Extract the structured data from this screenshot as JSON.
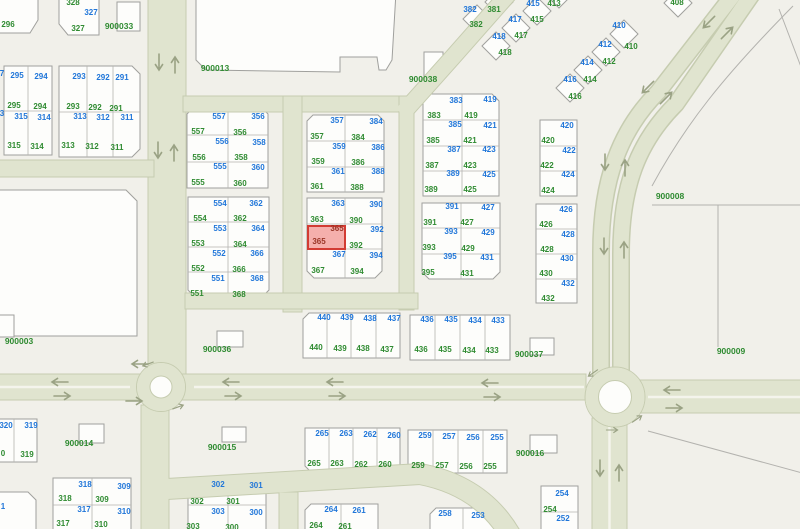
{
  "map": {
    "type": "cadastral-parcel-map",
    "theme": {
      "blue": "#2076d9",
      "green": "#2f8b31",
      "red": "#993325",
      "road": "#e0e4cf",
      "road-edge": "#c6ccb0",
      "bg": "#f1f0ea",
      "block": "#fdfdfb",
      "line": "#a0a09d",
      "grid": "#b4b3b0",
      "hl-fill": "rgba(238,112,108,0.55)",
      "hl-stroke": "#d23b33",
      "arrow": "#9aa284"
    },
    "highlight": {
      "number": "365",
      "x": 307,
      "y": 224.5,
      "w": 39,
      "h": 25
    },
    "block_labels": [
      "900003",
      "900008",
      "900009",
      "900013",
      "900014",
      "900015",
      "900016",
      "900033",
      "900036",
      "900037",
      "900038"
    ],
    "labels": [
      [
        "296",
        8,
        25,
        "g"
      ],
      [
        "328",
        73,
        3,
        "g"
      ],
      [
        "327",
        91,
        13,
        "b"
      ],
      [
        "327",
        78,
        29,
        "g"
      ],
      [
        "900033",
        119,
        26,
        "k"
      ],
      [
        "7",
        2,
        74,
        "b"
      ],
      [
        "3",
        2,
        114,
        "b"
      ],
      [
        "295",
        17,
        76,
        "b"
      ],
      [
        "294",
        41,
        77,
        "b"
      ],
      [
        "295",
        14,
        106,
        "g"
      ],
      [
        "294",
        40,
        107,
        "g"
      ],
      [
        "315",
        21,
        117,
        "b"
      ],
      [
        "314",
        44,
        118,
        "b"
      ],
      [
        "315",
        14,
        146,
        "g"
      ],
      [
        "314",
        37,
        147,
        "g"
      ],
      [
        "293",
        79,
        77,
        "b"
      ],
      [
        "292",
        103,
        78,
        "b"
      ],
      [
        "291",
        122,
        78,
        "b"
      ],
      [
        "293",
        73,
        107,
        "g"
      ],
      [
        "292",
        95,
        108,
        "g"
      ],
      [
        "291",
        116,
        109,
        "g"
      ],
      [
        "313",
        80,
        117,
        "b"
      ],
      [
        "312",
        103,
        118,
        "b"
      ],
      [
        "311",
        127,
        118,
        "b"
      ],
      [
        "313",
        68,
        146,
        "g"
      ],
      [
        "312",
        92,
        147,
        "g"
      ],
      [
        "311",
        117,
        148,
        "g"
      ],
      [
        "900013",
        215,
        68,
        "k"
      ],
      [
        "900003",
        19,
        341,
        "k"
      ],
      [
        "557",
        219,
        117,
        "b"
      ],
      [
        "356",
        258,
        117,
        "b"
      ],
      [
        "557",
        198,
        132,
        "g"
      ],
      [
        "356",
        240,
        133,
        "g"
      ],
      [
        "556",
        222,
        142,
        "b"
      ],
      [
        "358",
        259,
        143,
        "b"
      ],
      [
        "556",
        199,
        158,
        "g"
      ],
      [
        "358",
        241,
        158,
        "g"
      ],
      [
        "555",
        220,
        167,
        "b"
      ],
      [
        "360",
        258,
        168,
        "b"
      ],
      [
        "555",
        198,
        183,
        "g"
      ],
      [
        "360",
        240,
        184,
        "g"
      ],
      [
        "554",
        220,
        204,
        "b"
      ],
      [
        "362",
        256,
        204,
        "b"
      ],
      [
        "554",
        200,
        219,
        "g"
      ],
      [
        "362",
        240,
        219,
        "g"
      ],
      [
        "553",
        220,
        229,
        "b"
      ],
      [
        "364",
        258,
        229,
        "b"
      ],
      [
        "553",
        198,
        244,
        "g"
      ],
      [
        "364",
        240,
        245,
        "g"
      ],
      [
        "552",
        219,
        254,
        "b"
      ],
      [
        "366",
        257,
        254,
        "b"
      ],
      [
        "552",
        198,
        269,
        "g"
      ],
      [
        "366",
        239,
        270,
        "g"
      ],
      [
        "551",
        218,
        279,
        "b"
      ],
      [
        "368",
        257,
        279,
        "b"
      ],
      [
        "551",
        197,
        294,
        "g"
      ],
      [
        "368",
        239,
        295,
        "g"
      ],
      [
        "357",
        337,
        121,
        "b"
      ],
      [
        "384",
        376,
        122,
        "b"
      ],
      [
        "357",
        317,
        137,
        "g"
      ],
      [
        "384",
        358,
        138,
        "g"
      ],
      [
        "359",
        339,
        147,
        "b"
      ],
      [
        "386",
        378,
        148,
        "b"
      ],
      [
        "359",
        318,
        162,
        "g"
      ],
      [
        "386",
        358,
        163,
        "g"
      ],
      [
        "361",
        338,
        172,
        "b"
      ],
      [
        "388",
        378,
        172,
        "b"
      ],
      [
        "361",
        317,
        187,
        "g"
      ],
      [
        "388",
        357,
        188,
        "g"
      ],
      [
        "363",
        338,
        204,
        "b"
      ],
      [
        "390",
        376,
        205,
        "b"
      ],
      [
        "363",
        317,
        220,
        "g"
      ],
      [
        "390",
        356,
        221,
        "g"
      ],
      [
        "365",
        337,
        229,
        "r"
      ],
      [
        "392",
        377,
        230,
        "b"
      ],
      [
        "365",
        319,
        242,
        "r"
      ],
      [
        "392",
        356,
        246,
        "g"
      ],
      [
        "367",
        339,
        255,
        "b"
      ],
      [
        "394",
        376,
        256,
        "b"
      ],
      [
        "367",
        318,
        271,
        "g"
      ],
      [
        "394",
        357,
        272,
        "g"
      ],
      [
        "383",
        456,
        101,
        "b"
      ],
      [
        "419",
        490,
        100,
        "b"
      ],
      [
        "383",
        434,
        116,
        "g"
      ],
      [
        "419",
        471,
        116,
        "g"
      ],
      [
        "385",
        455,
        125,
        "b"
      ],
      [
        "421",
        490,
        126,
        "b"
      ],
      [
        "385",
        433,
        141,
        "g"
      ],
      [
        "421",
        470,
        141,
        "g"
      ],
      [
        "387",
        454,
        150,
        "b"
      ],
      [
        "423",
        489,
        150,
        "b"
      ],
      [
        "387",
        432,
        166,
        "g"
      ],
      [
        "423",
        470,
        166,
        "g"
      ],
      [
        "389",
        453,
        174,
        "b"
      ],
      [
        "425",
        489,
        175,
        "b"
      ],
      [
        "389",
        431,
        190,
        "g"
      ],
      [
        "425",
        470,
        190,
        "g"
      ],
      [
        "391",
        452,
        207,
        "b"
      ],
      [
        "427",
        488,
        208,
        "b"
      ],
      [
        "391",
        430,
        223,
        "g"
      ],
      [
        "427",
        467,
        223,
        "g"
      ],
      [
        "393",
        451,
        232,
        "b"
      ],
      [
        "429",
        488,
        233,
        "b"
      ],
      [
        "393",
        429,
        248,
        "g"
      ],
      [
        "429",
        468,
        249,
        "g"
      ],
      [
        "395",
        450,
        257,
        "b"
      ],
      [
        "431",
        487,
        258,
        "b"
      ],
      [
        "395",
        428,
        273,
        "g"
      ],
      [
        "431",
        467,
        274,
        "g"
      ],
      [
        "420",
        567,
        126,
        "b"
      ],
      [
        "420",
        548,
        141,
        "g"
      ],
      [
        "422",
        569,
        151,
        "b"
      ],
      [
        "422",
        547,
        166,
        "g"
      ],
      [
        "424",
        568,
        175,
        "b"
      ],
      [
        "424",
        548,
        191,
        "g"
      ],
      [
        "426",
        566,
        210,
        "b"
      ],
      [
        "426",
        546,
        225,
        "g"
      ],
      [
        "428",
        568,
        235,
        "b"
      ],
      [
        "428",
        547,
        250,
        "g"
      ],
      [
        "430",
        567,
        259,
        "b"
      ],
      [
        "430",
        546,
        274,
        "g"
      ],
      [
        "432",
        568,
        284,
        "b"
      ],
      [
        "432",
        548,
        299,
        "g"
      ],
      [
        "382",
        470,
        10,
        "b"
      ],
      [
        "381",
        494,
        10,
        "g"
      ],
      [
        "415",
        533,
        4,
        "b"
      ],
      [
        "413",
        554,
        4,
        "g"
      ],
      [
        "417",
        515,
        20,
        "b"
      ],
      [
        "415",
        537,
        20,
        "g"
      ],
      [
        "382",
        476,
        25,
        "g"
      ],
      [
        "418",
        499,
        37,
        "b"
      ],
      [
        "417",
        521,
        36,
        "g"
      ],
      [
        "418",
        505,
        53,
        "g"
      ],
      [
        "410",
        619,
        26,
        "b"
      ],
      [
        "410",
        631,
        47,
        "g"
      ],
      [
        "412",
        605,
        45,
        "b"
      ],
      [
        "412",
        609,
        62,
        "g"
      ],
      [
        "414",
        587,
        63,
        "b"
      ],
      [
        "414",
        590,
        80,
        "g"
      ],
      [
        "416",
        570,
        80,
        "b"
      ],
      [
        "416",
        575,
        97,
        "g"
      ],
      [
        "408",
        677,
        3,
        "g"
      ],
      [
        "900038",
        423,
        79,
        "k"
      ],
      [
        "900008",
        670,
        196,
        "k"
      ],
      [
        "900009",
        731,
        351,
        "k"
      ],
      [
        "900036",
        217,
        349,
        "k"
      ],
      [
        "900037",
        529,
        354,
        "k"
      ],
      [
        "900014",
        79,
        443,
        "k"
      ],
      [
        "900015",
        222,
        447,
        "k"
      ],
      [
        "900016",
        530,
        453,
        "k"
      ],
      [
        "440",
        324,
        318,
        "b"
      ],
      [
        "439",
        347,
        318,
        "b"
      ],
      [
        "438",
        370,
        319,
        "b"
      ],
      [
        "437",
        394,
        319,
        "b"
      ],
      [
        "440",
        316,
        348,
        "g"
      ],
      [
        "439",
        340,
        349,
        "g"
      ],
      [
        "438",
        363,
        349,
        "g"
      ],
      [
        "437",
        387,
        350,
        "g"
      ],
      [
        "436",
        427,
        320,
        "b"
      ],
      [
        "435",
        451,
        320,
        "b"
      ],
      [
        "434",
        475,
        321,
        "b"
      ],
      [
        "433",
        498,
        321,
        "b"
      ],
      [
        "436",
        421,
        350,
        "g"
      ],
      [
        "435",
        445,
        350,
        "g"
      ],
      [
        "434",
        469,
        351,
        "g"
      ],
      [
        "433",
        492,
        351,
        "g"
      ],
      [
        "265",
        322,
        434,
        "b"
      ],
      [
        "263",
        346,
        434,
        "b"
      ],
      [
        "262",
        370,
        435,
        "b"
      ],
      [
        "260",
        394,
        436,
        "b"
      ],
      [
        "265",
        314,
        464,
        "g"
      ],
      [
        "263",
        337,
        464,
        "g"
      ],
      [
        "262",
        361,
        465,
        "g"
      ],
      [
        "260",
        385,
        465,
        "g"
      ],
      [
        "259",
        425,
        436,
        "b"
      ],
      [
        "257",
        449,
        437,
        "b"
      ],
      [
        "256",
        473,
        438,
        "b"
      ],
      [
        "255",
        497,
        438,
        "b"
      ],
      [
        "259",
        418,
        466,
        "g"
      ],
      [
        "257",
        442,
        466,
        "g"
      ],
      [
        "256",
        466,
        467,
        "g"
      ],
      [
        "255",
        490,
        467,
        "g"
      ],
      [
        "320",
        6,
        426,
        "b"
      ],
      [
        "319",
        31,
        426,
        "b"
      ],
      [
        "0",
        3,
        454,
        "g"
      ],
      [
        "319",
        27,
        455,
        "g"
      ],
      [
        "1",
        3,
        507,
        "b"
      ],
      [
        "318",
        85,
        485,
        "b"
      ],
      [
        "309",
        124,
        487,
        "b"
      ],
      [
        "318",
        65,
        499,
        "g"
      ],
      [
        "309",
        102,
        500,
        "g"
      ],
      [
        "317",
        84,
        510,
        "b"
      ],
      [
        "310",
        124,
        512,
        "b"
      ],
      [
        "317",
        63,
        524,
        "g"
      ],
      [
        "310",
        101,
        525,
        "g"
      ],
      [
        "302",
        218,
        485,
        "b"
      ],
      [
        "301",
        256,
        486,
        "b"
      ],
      [
        "302",
        197,
        502,
        "g"
      ],
      [
        "301",
        233,
        502,
        "g"
      ],
      [
        "303",
        218,
        512,
        "b"
      ],
      [
        "300",
        256,
        513,
        "b"
      ],
      [
        "303",
        193,
        527,
        "g"
      ],
      [
        "300",
        232,
        528,
        "g"
      ],
      [
        "264",
        331,
        510,
        "b"
      ],
      [
        "261",
        359,
        511,
        "b"
      ],
      [
        "264",
        316,
        526,
        "g"
      ],
      [
        "261",
        345,
        527,
        "g"
      ],
      [
        "258",
        445,
        514,
        "b"
      ],
      [
        "253",
        478,
        516,
        "b"
      ],
      [
        "254",
        562,
        494,
        "b"
      ],
      [
        "254",
        550,
        510,
        "g"
      ],
      [
        "252",
        563,
        519,
        "b"
      ]
    ]
  }
}
